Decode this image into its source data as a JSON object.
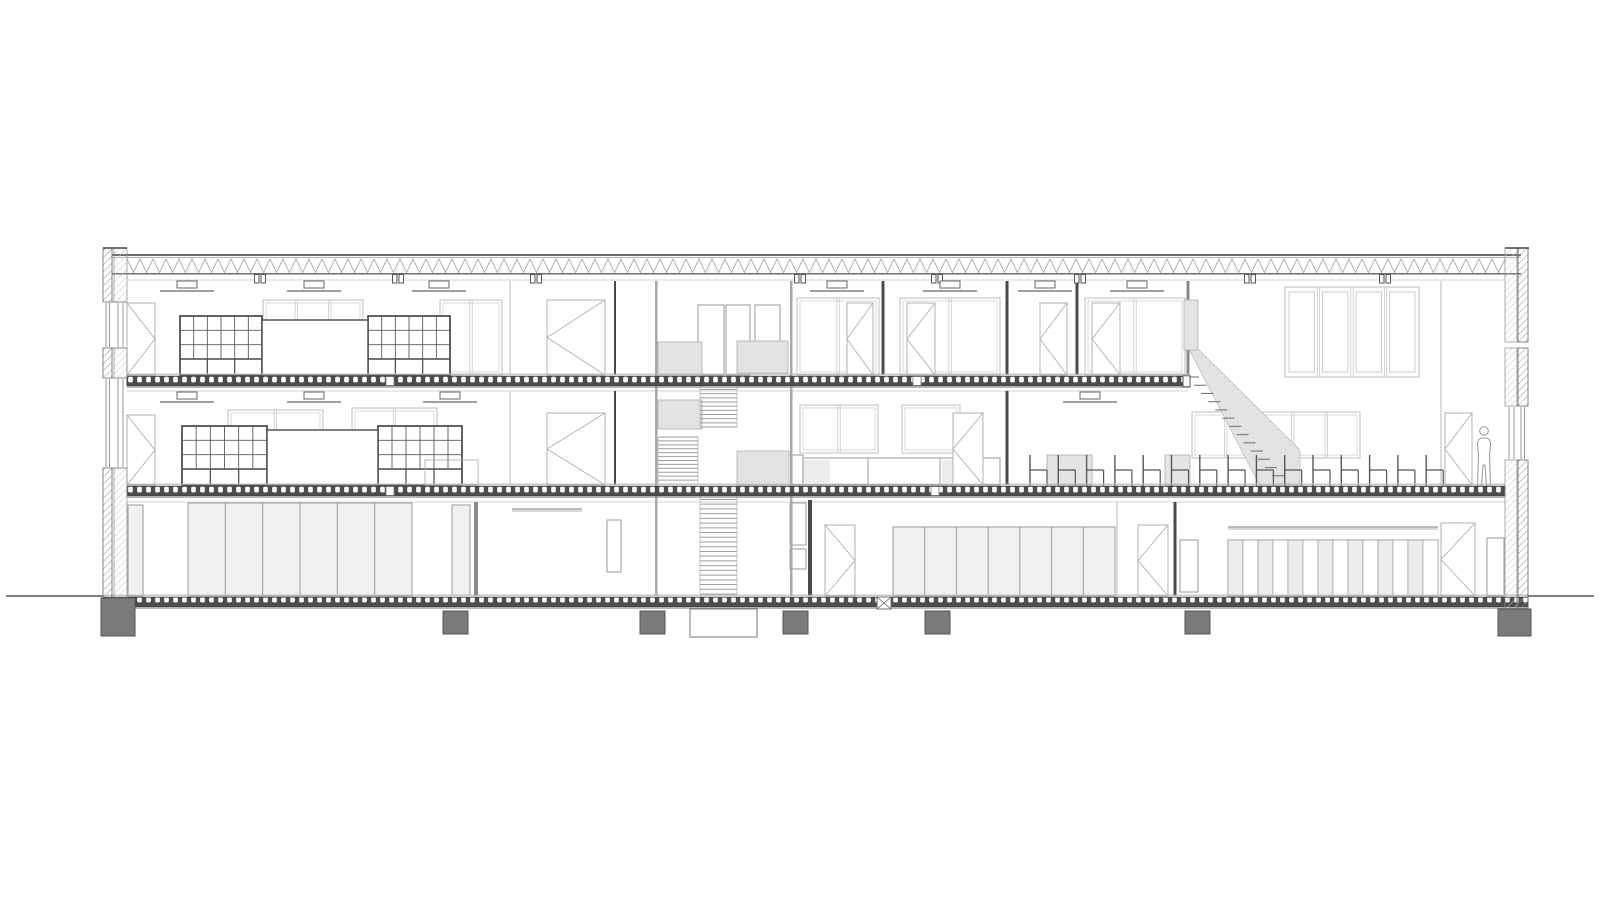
{
  "meta": {
    "title": "Architectural longitudinal section - three-storey building with central stair core, double-height hall, canteen seating and scale figure",
    "drawing_type": "architectural-section"
  },
  "canvas": {
    "w": 1600,
    "h": 900,
    "bg": "#ffffff"
  },
  "colors": {
    "ink": "#3f3f3f",
    "mid": "#8a8a8a",
    "light": "#b0b0b0",
    "faint": "#c9c9c9",
    "hatch": "#9a9a9a",
    "slab": "#4d4d4d",
    "shade": "#e4e4e4",
    "glass": "#f1f1f1",
    "locker": "#ececec",
    "footing": "#7b7b7b",
    "white": "#ffffff",
    "wall": "#a8a8a8"
  },
  "ground_y": 596,
  "ground_lines": [
    [
      6,
      103
    ],
    [
      1528,
      1594
    ]
  ],
  "walls": {
    "left": {
      "outer_x": 103,
      "outer_w": 9,
      "inner_x": 114,
      "inner_w": 13,
      "top": 248,
      "bottom": 614,
      "solid": [
        [
          248,
          302
        ],
        [
          348,
          378
        ],
        [
          468,
          614
        ]
      ],
      "windows": [
        [
          302,
          348
        ],
        [
          378,
          468
        ]
      ]
    },
    "right": {
      "outer_x": 1518,
      "outer_w": 10,
      "inner_x": 1505,
      "inner_w": 12,
      "top": 248,
      "bottom": 610,
      "solid": [
        [
          248,
          342
        ],
        [
          348,
          406
        ],
        [
          460,
          610
        ]
      ],
      "windows": [
        [
          406,
          460
        ]
      ]
    }
  },
  "roof": {
    "x1": 112,
    "x2": 1521,
    "zx1": 127,
    "zx2": 1505,
    "chord_top": 255,
    "chord_top2": 257.3,
    "zig_top": 259,
    "zig_bot": 272.5,
    "chord_bot": 273.8,
    "zig_period": 13,
    "hangers": [
      260,
      398,
      536,
      800,
      937,
      1080,
      1250,
      1385
    ]
  },
  "ceil_lines": [
    [
      127,
      1505,
      280
    ],
    [
      127,
      1188,
      391
    ],
    [
      127,
      1505,
      502
    ]
  ],
  "slabs": [
    {
      "name": "upper-floor-slab",
      "x1": 127,
      "x2": 1190,
      "top": 375,
      "joints": [
        390,
        917
      ],
      "cap_right": true
    },
    {
      "name": "mid-floor-slab",
      "x1": 127,
      "x2": 1505,
      "top": 485,
      "joints": [
        390,
        935
      ],
      "cap_right": false
    },
    {
      "name": "ground-slab",
      "x1": 103,
      "x2": 1528,
      "top": 596,
      "joints": [],
      "cap_right": false
    }
  ],
  "partitions": [
    [
      615,
      281,
      375,
      2,
      "ink"
    ],
    [
      615,
      391,
      485,
      2,
      "ink"
    ],
    [
      883,
      281,
      375,
      3,
      "ink"
    ],
    [
      1007,
      281,
      375,
      3,
      "ink"
    ],
    [
      1077,
      281,
      375,
      3,
      "ink"
    ],
    [
      510,
      281,
      375,
      1.2,
      "faint"
    ],
    [
      510,
      391,
      485,
      1.2,
      "faint"
    ],
    [
      1007,
      391,
      485,
      3,
      "ink"
    ],
    [
      476,
      502,
      596,
      4,
      "mid"
    ],
    [
      810,
      500,
      596,
      4,
      "ink"
    ],
    [
      1117,
      502,
      596,
      1.2,
      "faint"
    ],
    [
      1175,
      502,
      596,
      3,
      "ink"
    ],
    [
      1188,
      281,
      375,
      3,
      "mid"
    ],
    [
      1441,
      281,
      485,
      1.2,
      "faint"
    ]
  ],
  "windows": [
    {
      "x": 263,
      "y": 300,
      "w": 100,
      "h": 75,
      "panes": 3,
      "double": false
    },
    {
      "x": 440,
      "y": 300,
      "w": 62,
      "h": 75,
      "panes": 2,
      "double": false
    },
    {
      "x": 797,
      "y": 298,
      "w": 82,
      "h": 77,
      "panes": 2,
      "double": false
    },
    {
      "x": 900,
      "y": 298,
      "w": 100,
      "h": 77,
      "panes": 2,
      "double": false
    },
    {
      "x": 1085,
      "y": 298,
      "w": 100,
      "h": 77,
      "panes": 2,
      "double": false
    },
    {
      "x": 228,
      "y": 410,
      "w": 95,
      "h": 75,
      "panes": 2,
      "double": false
    },
    {
      "x": 352,
      "y": 408,
      "w": 85,
      "h": 40,
      "panes": 2,
      "double": false
    },
    {
      "x": 800,
      "y": 405,
      "w": 78,
      "h": 48,
      "panes": 2,
      "double": false
    },
    {
      "x": 902,
      "y": 405,
      "w": 58,
      "h": 48,
      "panes": 1,
      "double": false
    },
    {
      "x": 1192,
      "y": 412,
      "w": 168,
      "h": 46,
      "panes": 5,
      "double": false
    },
    {
      "x": 1285,
      "y": 287,
      "w": 134,
      "h": 90,
      "panes": 4,
      "double": true
    }
  ],
  "shelving": {
    "grids": [
      [
        180,
        316,
        82,
        59
      ],
      [
        368,
        316,
        82,
        59
      ],
      [
        182,
        426,
        85,
        59
      ],
      [
        378,
        426,
        84,
        59
      ]
    ],
    "boards": [
      [
        262,
        320,
        106,
        55
      ],
      [
        267,
        430,
        111,
        55
      ]
    ],
    "cabinets": [
      [
        425,
        460,
        53,
        25
      ]
    ]
  },
  "tables": {
    "counter": {
      "x": 795,
      "y": 458,
      "w": 205,
      "h": 27,
      "dividers": [
        868,
        940
      ],
      "faces": [
        [
          797,
          33
        ],
        [
          942,
          33
        ]
      ]
    },
    "canteen": [
      [
        1047,
        45
      ],
      [
        1165,
        25
      ]
    ],
    "canteen_y": 455,
    "canteen_h": 30,
    "desk_line": [
      512,
      582,
      509
    ]
  },
  "doors": [
    [
      127,
      303,
      28,
      72,
      "right"
    ],
    [
      547,
      300,
      58,
      75,
      "left"
    ],
    [
      847,
      303,
      26,
      72,
      "left"
    ],
    [
      907,
      303,
      28,
      72,
      "left"
    ],
    [
      1040,
      303,
      27,
      72,
      "left"
    ],
    [
      1092,
      303,
      28,
      72,
      "left"
    ],
    [
      127,
      415,
      28,
      70,
      "right"
    ],
    [
      547,
      413,
      58,
      72,
      "left"
    ],
    [
      953,
      413,
      30,
      72,
      "left"
    ],
    [
      1445,
      413,
      27,
      72,
      "left"
    ],
    [
      825,
      525,
      30,
      71,
      "right"
    ],
    [
      1138,
      525,
      30,
      71,
      "left"
    ],
    [
      1441,
      523,
      34,
      73,
      "left"
    ]
  ],
  "plain_doors": [
    [
      607,
      520,
      14,
      52
    ],
    [
      1180,
      540,
      18,
      52
    ],
    [
      1487,
      538,
      17,
      58
    ],
    [
      698,
      305,
      26,
      70
    ],
    [
      726,
      305,
      24,
      70
    ],
    [
      755,
      305,
      25,
      37
    ],
    [
      788,
      455,
      15,
      30
    ],
    [
      790,
      503,
      16,
      42
    ],
    [
      790,
      549,
      16,
      20
    ]
  ],
  "core": {
    "wall_left": 655,
    "wall_right": 790,
    "wall_top": 281,
    "wall_bottom": 596,
    "wall_w": 2.5,
    "blocks": [
      [
        658,
        342,
        44,
        33
      ],
      [
        737,
        341,
        51,
        32
      ],
      [
        658,
        400,
        44,
        29
      ],
      [
        737,
        451,
        52,
        34
      ]
    ],
    "flights": [
      {
        "x": 700,
        "w": 37,
        "y1": 377,
        "y2": 427,
        "n": 12
      },
      {
        "x": 658,
        "w": 40,
        "y1": 437,
        "y2": 484,
        "n": 12
      },
      {
        "x": 700,
        "w": 37,
        "y1": 490,
        "y2": 594,
        "n": 22
      }
    ]
  },
  "big_stair": {
    "poly": [
      [
        1190,
        341
      ],
      [
        1300,
        450
      ],
      [
        1300,
        486
      ],
      [
        1260,
        486
      ],
      [
        1190,
        351
      ]
    ],
    "tread_from": [
      1192,
      377
    ],
    "tread_to": [
      1284,
      484
    ],
    "n": 14,
    "spandrel": [
      1184,
      300,
      14,
      50
    ]
  },
  "chairs": {
    "start": 1030,
    "spacing": 28.3,
    "count": 15,
    "floor": 486,
    "back": 31,
    "seat_w": 17,
    "seat_h": 16
  },
  "ground_glazing": [
    {
      "x": 128,
      "y": 505,
      "w": 15,
      "h": 91,
      "panes": 1
    },
    {
      "x": 188,
      "y": 503,
      "w": 224,
      "h": 93,
      "panes": 6
    },
    {
      "x": 452,
      "y": 505,
      "w": 18,
      "h": 90,
      "panes": 1
    },
    {
      "x": 893,
      "y": 527,
      "w": 222,
      "h": 69,
      "panes": 7
    }
  ],
  "lockers": {
    "x": 1228,
    "y": 540,
    "w": 210,
    "h": 56,
    "panes": 14,
    "shelf_y": 527
  },
  "figure": {
    "cx": 1484,
    "head_y": 432,
    "feet_y": 486
  },
  "lights": {
    "top": {
      "ceiling": 280,
      "xs": [
        187,
        314,
        439,
        837,
        950,
        1045,
        1137
      ]
    },
    "mid": {
      "ceiling": 391,
      "xs": [
        187,
        314,
        450,
        1090
      ]
    }
  },
  "foundations": {
    "footings": [
      [
        101,
        598,
        34,
        38
      ],
      [
        443,
        611,
        25,
        23
      ],
      [
        640,
        611,
        25,
        23
      ],
      [
        783,
        611,
        25,
        23
      ],
      [
        925,
        611,
        25,
        23
      ],
      [
        1185,
        611,
        25,
        23
      ],
      [
        1498,
        609,
        33,
        27
      ]
    ],
    "pit": [
      690,
      609,
      67,
      28
    ],
    "xbox": [
      877,
      597,
      14,
      12
    ]
  }
}
